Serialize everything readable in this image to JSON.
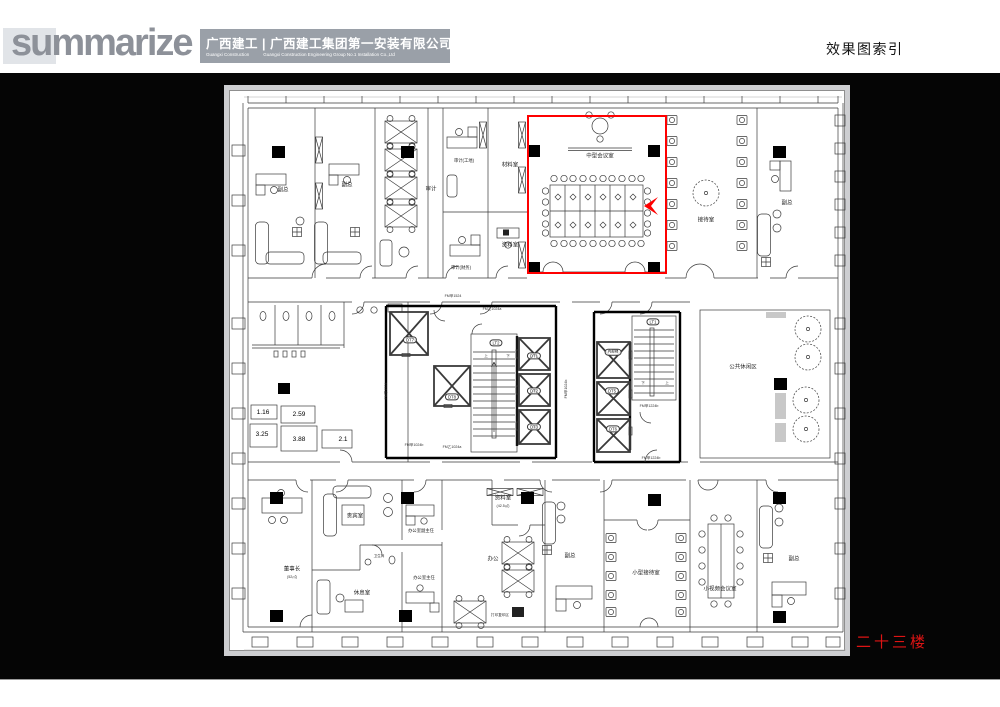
{
  "header": {
    "logo": "summarize",
    "company_cn": "广西建工 | 广西建工集团第一安装有限公司",
    "company_en_1": "Guangxi Construction",
    "company_en_2": "Guangxi Construction Engineering Group No.1 Installation Co.,Ltd",
    "page_title": "效果图索引"
  },
  "slide": {
    "floor_label": "二十三楼",
    "highlight_color": "#fe0000"
  },
  "plan": {
    "labels": {
      "vp1": "副总",
      "vp2": "副总",
      "vp3": "副总",
      "vp4": "副总",
      "vp5": "副总",
      "audit": "审计",
      "audit_site": "审计(工地)",
      "audit_fin": "审计(财务)",
      "material_room": "材料室",
      "archive_room_top": "资料室",
      "meeting_mid": "中型会议室",
      "reception_room": "接待室",
      "lounge_area": "公共休闲区",
      "chairman": "董事长",
      "chairman_area": "(52㎡)",
      "vip_room": "贵宾室",
      "bathroom": "卫生间",
      "rest_room": "休息室",
      "office_deputy_director": "办公室副主任",
      "office_director": "办公室主任",
      "office_open": "办公",
      "archive_room_bottom": "资料室",
      "archive_bottom_area": "(42.5㎡)",
      "print_area": "打印复印区",
      "reception_small": "小型接待室",
      "video_meeting_small": "小视频会议室",
      "internal_lift": "内部梯",
      "dt1": "DT1",
      "dt2": "DT2",
      "dt3": "DT3",
      "dt5": "DT5",
      "dt6": "DT6",
      "dt7": "DT7",
      "dt8": "DT8",
      "lt1": "LT1",
      "lt2": "LT2",
      "up": "上",
      "down": "下",
      "fm_jia_1524": "FM甲1524",
      "fm_yi_1024a": "FM乙1024a",
      "fm_jia_1024b": "FM甲1024b",
      "fm_jia_1224b": "FM甲1224b",
      "n_116": "1.16",
      "n_259": "2.59",
      "n_325": "3.25",
      "n_388": "3.88",
      "n_21": "2.1"
    }
  }
}
